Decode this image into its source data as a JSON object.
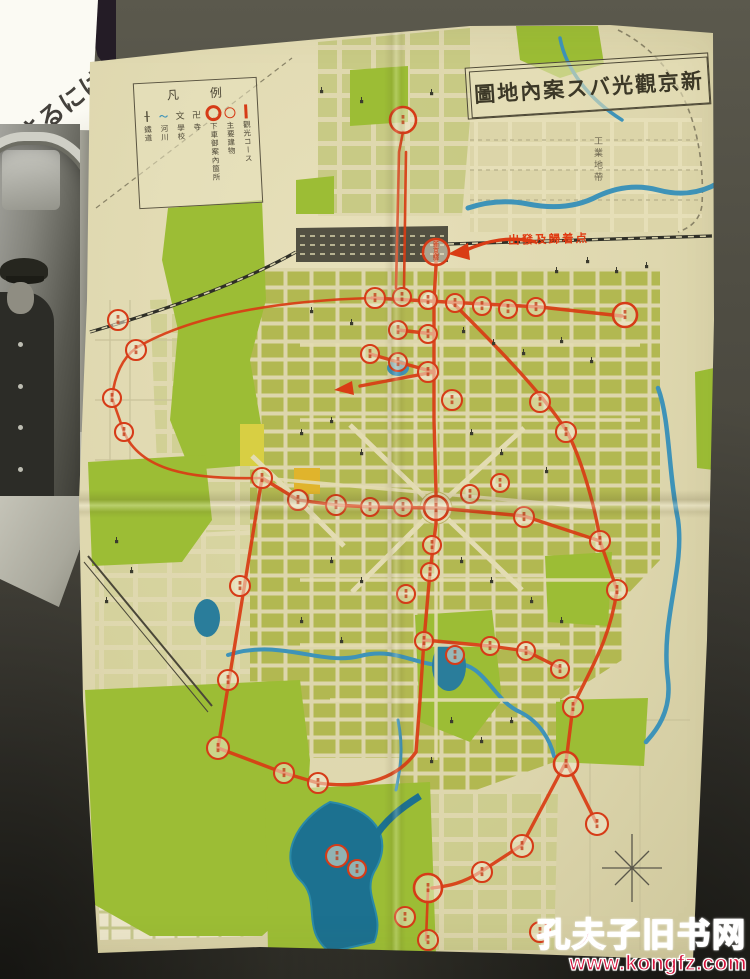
{
  "book_page": {
    "diagonal_text": "なさるには"
  },
  "map": {
    "title": {
      "text": "新京觀光バス案內地圖",
      "display": "圖地內案スバ光觀京新"
    },
    "legend": {
      "title": "凡例",
      "title_display": "凡 例",
      "items": [
        {
          "symbol": "route-line",
          "label": "觀光コース"
        },
        {
          "symbol": "open-circle",
          "label": "主要建物"
        },
        {
          "symbol": "ring-circle",
          "label": "下車御案內箇所"
        },
        {
          "symbol": "glyph",
          "glyph": "卍",
          "label": "寺"
        },
        {
          "symbol": "glyph",
          "glyph": "文",
          "label": "學校"
        },
        {
          "symbol": "glyph river",
          "glyph": "〜",
          "label": "河川"
        },
        {
          "symbol": "glyph",
          "glyph": "╂",
          "label": "鐵道"
        }
      ]
    },
    "labels": {
      "departure_point": "出發及歸着点",
      "industrial_zone": "工業地帶",
      "station_stop": "新京驛"
    },
    "colors": {
      "route_red": "#d93c14",
      "park_green": "#9cbd35",
      "river_blue": "#3e93b8",
      "paper": "#ded7ae"
    },
    "stops": [
      [
        403,
        120,
        13
      ],
      [
        436,
        252,
        13,
        "新京驛"
      ],
      [
        375,
        298,
        10
      ],
      [
        402,
        297,
        9
      ],
      [
        428,
        300,
        9
      ],
      [
        455,
        303,
        9
      ],
      [
        482,
        306,
        9
      ],
      [
        508,
        309,
        9
      ],
      [
        536,
        307,
        9
      ],
      [
        625,
        315,
        12
      ],
      [
        398,
        330,
        9
      ],
      [
        428,
        334,
        9
      ],
      [
        370,
        354,
        9
      ],
      [
        398,
        362,
        9
      ],
      [
        428,
        372,
        10
      ],
      [
        452,
        400,
        10
      ],
      [
        540,
        402,
        10
      ],
      [
        566,
        432,
        10
      ],
      [
        118,
        320,
        10
      ],
      [
        136,
        350,
        10
      ],
      [
        112,
        398,
        9
      ],
      [
        124,
        432,
        9
      ],
      [
        262,
        478,
        10
      ],
      [
        298,
        500,
        10
      ],
      [
        336,
        505,
        10
      ],
      [
        370,
        507,
        9
      ],
      [
        403,
        507,
        9
      ],
      [
        436,
        508,
        12
      ],
      [
        470,
        494,
        9
      ],
      [
        500,
        483,
        9
      ],
      [
        524,
        517,
        10
      ],
      [
        600,
        541,
        10
      ],
      [
        617,
        590,
        10
      ],
      [
        432,
        545,
        9
      ],
      [
        430,
        572,
        9
      ],
      [
        406,
        594,
        9
      ],
      [
        240,
        586,
        10
      ],
      [
        228,
        680,
        10
      ],
      [
        218,
        748,
        11
      ],
      [
        284,
        773,
        10
      ],
      [
        318,
        783,
        10
      ],
      [
        424,
        641,
        9
      ],
      [
        455,
        655,
        9
      ],
      [
        490,
        646,
        9
      ],
      [
        526,
        651,
        9
      ],
      [
        560,
        669,
        9
      ],
      [
        573,
        707,
        10
      ],
      [
        566,
        764,
        12
      ],
      [
        597,
        824,
        11
      ],
      [
        522,
        846,
        11
      ],
      [
        482,
        872,
        10
      ],
      [
        337,
        856,
        11
      ],
      [
        357,
        869,
        9
      ],
      [
        428,
        888,
        14
      ],
      [
        405,
        917,
        10
      ],
      [
        428,
        940,
        10
      ],
      [
        540,
        932,
        10
      ]
    ],
    "landmarks": [
      [
        320,
        90
      ],
      [
        360,
        100
      ],
      [
        430,
        92
      ],
      [
        310,
        310
      ],
      [
        350,
        322
      ],
      [
        462,
        330
      ],
      [
        492,
        342
      ],
      [
        522,
        352
      ],
      [
        560,
        340
      ],
      [
        590,
        360
      ],
      [
        330,
        420
      ],
      [
        360,
        452
      ],
      [
        470,
        432
      ],
      [
        500,
        452
      ],
      [
        545,
        470
      ],
      [
        300,
        432
      ],
      [
        330,
        560
      ],
      [
        360,
        580
      ],
      [
        460,
        560
      ],
      [
        490,
        580
      ],
      [
        530,
        600
      ],
      [
        560,
        620
      ],
      [
        450,
        720
      ],
      [
        480,
        740
      ],
      [
        340,
        640
      ],
      [
        300,
        620
      ],
      [
        510,
        720
      ],
      [
        430,
        760
      ],
      [
        586,
        260
      ],
      [
        615,
        270
      ],
      [
        645,
        265
      ],
      [
        555,
        270
      ],
      [
        115,
        540
      ],
      [
        130,
        570
      ],
      [
        105,
        600
      ]
    ]
  },
  "watermark": {
    "line1": "孔夫子旧书网",
    "line2": "www.kongfz.com"
  }
}
